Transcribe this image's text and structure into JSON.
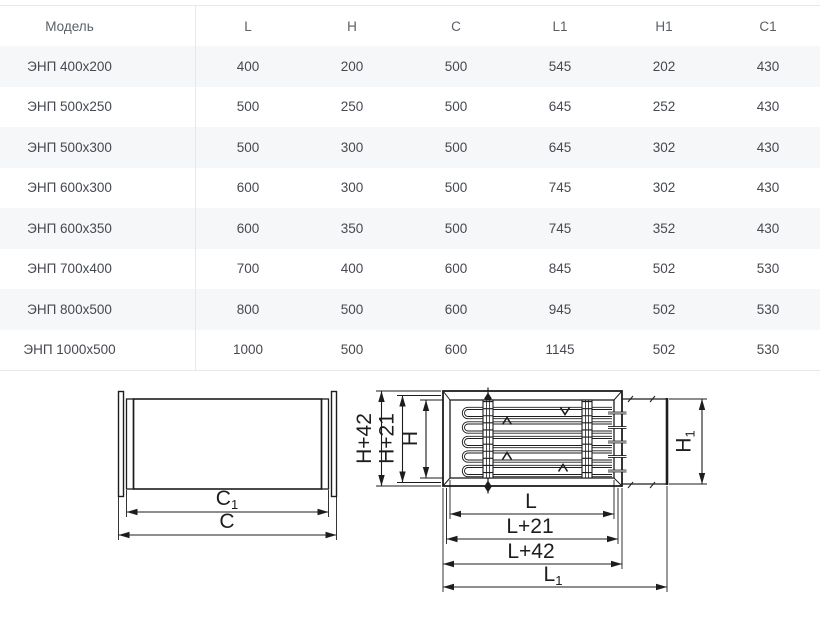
{
  "colors": {
    "background": "#ffffff",
    "table_border": "#e7e8ea",
    "row_stripe": "#f6f7f8",
    "table_text": "#45494f",
    "header_text": "#5b6066",
    "drawing_ink": "#1d1d1f"
  },
  "table": {
    "headers": [
      "Модель",
      "L",
      "H",
      "C",
      "L1",
      "H1",
      "C1"
    ],
    "rows": [
      [
        "ЭНП 400x200",
        "400",
        "200",
        "500",
        "545",
        "202",
        "430"
      ],
      [
        "ЭНП 500x250",
        "500",
        "250",
        "500",
        "645",
        "252",
        "430"
      ],
      [
        "ЭНП 500x300",
        "500",
        "300",
        "500",
        "645",
        "302",
        "430"
      ],
      [
        "ЭНП 600x300",
        "600",
        "300",
        "500",
        "745",
        "302",
        "430"
      ],
      [
        "ЭНП 600x350",
        "600",
        "350",
        "500",
        "745",
        "352",
        "430"
      ],
      [
        "ЭНП 700x400",
        "700",
        "400",
        "600",
        "845",
        "502",
        "530"
      ],
      [
        "ЭНП 800x500",
        "800",
        "500",
        "600",
        "945",
        "502",
        "530"
      ],
      [
        "ЭНП 1000x500",
        "1000",
        "500",
        "600",
        "1145",
        "502",
        "530"
      ]
    ]
  },
  "diagrams": {
    "left": {
      "label_c1": {
        "base": "C",
        "sub": "1"
      },
      "label_c": "C"
    },
    "right": {
      "label_h42": "H+42",
      "label_h21": "H+21",
      "label_h": "H",
      "label_h1": {
        "base": "H",
        "sub": "1"
      },
      "label_l": "L",
      "label_l21": "L+21",
      "label_l42": "L+42",
      "label_l1": {
        "base": "L",
        "sub": "1"
      }
    }
  }
}
